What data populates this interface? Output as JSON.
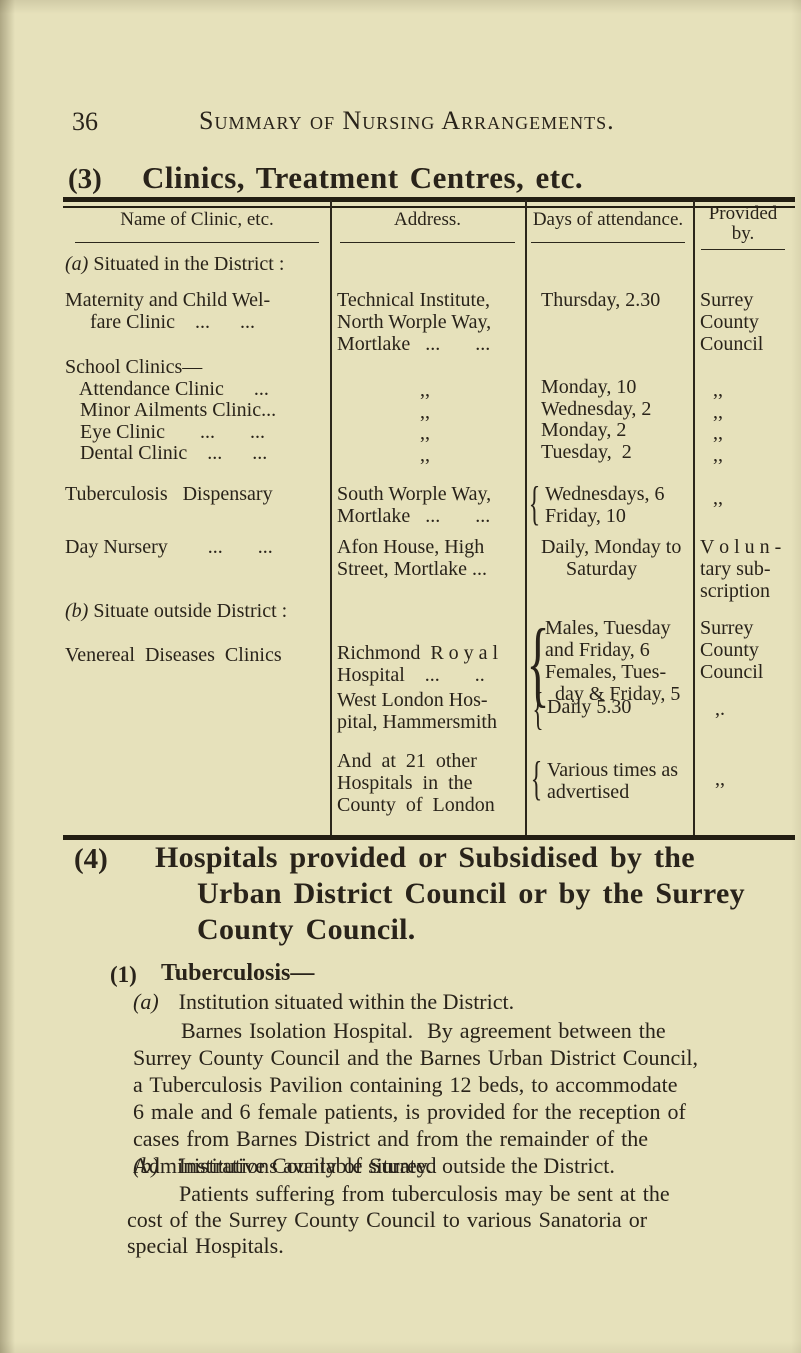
{
  "page": {
    "number": "36",
    "running_title": "Summary of Nursing Arrangements."
  },
  "section3": {
    "num": "(3)",
    "title": "Clinics, Treatment Centres, etc."
  },
  "table": {
    "brace_glyph": "{",
    "headers": {
      "name": "Name of Clinic, etc.",
      "address": "Address.",
      "days": "Days of attendance.",
      "provided": "Provided\nby."
    },
    "group_a": {
      "num": "(a)",
      "label": "Situated in the District :"
    },
    "maternity": {
      "name": "Maternity and Child Wel-\n     fare Clinic    ...      ...",
      "address": "Technical Institute,\nNorth Worple Way,\nMortlake   ...       ...",
      "days": "Thursday, 2.30",
      "provided": "Surrey\nCounty\nCouncil"
    },
    "school": {
      "name": "School Clinics—\n   Attendance Clinic      ...\n   Minor Ailments Clinic...\n   Eye Clinic       ...       ...\n   Dental Clinic    ...      ...",
      "address_ditto": ",,\n,,\n,,\n,,",
      "days": "Monday, 10\nWednesday, 2\nMonday, 2\nTuesday,  2",
      "provided_ditto": ",,\n,,\n,,\n,,"
    },
    "tuberculosis": {
      "name": "Tuberculosis   Dispensary",
      "address": "South Worple Way,\nMortlake   ...       ...",
      "days": "Wednesdays, 6\nFriday, 10",
      "provided": ",,"
    },
    "day_nursery": {
      "name": "Day Nursery        ...       ...",
      "address": "Afon House, High\nStreet, Mortlake ...",
      "days": "Daily, Monday to\n     Saturday",
      "provided": "V o l u n -\ntary sub-\nscription"
    },
    "group_b": {
      "num": "(b)",
      "label": "Situate outside District :"
    },
    "venereal": {
      "name": "Venereal  Diseases  Clinics",
      "address": "Richmond  R o y a l\nHospital    ...       ..",
      "days": "Males, Tuesday\nand Friday, 6\nFemales, Tues-\n  day & Friday, 5",
      "provided": "Surrey\nCounty\nCouncil"
    },
    "west_london": {
      "address": "West London Hos-\npital, Hammersmith",
      "days": "Daily 5.30",
      "provided": ",."
    },
    "other_hospitals": {
      "address": "And  at  21  other\nHospitals  in  the\nCounty  of  London",
      "days": "Various times as\nadvertised",
      "provided": ",,"
    }
  },
  "section4": {
    "num": "(4)",
    "lines": [
      "Hospitals provided or Subsidised by the",
      "Urban District Council or by the Surrey",
      "County Council."
    ]
  },
  "tuberculosis_section": {
    "num": "(1)",
    "title": "Tuberculosis—",
    "item_a": {
      "num": "(a)",
      "text": "Institution situated within the District."
    },
    "para_a": "Barnes Isolation Hospital.  By agreement between the\nSurrey County Council and the Barnes Urban District Council,\na Tuberculosis Pavilion containing 12 beds, to accommodate\n6 male and 6 female patients, is provided for the reception of\ncases from Barnes District and from the remainder of the\nAdministrative County of Surrey.",
    "item_b": {
      "num": "(b)",
      "text": "Institutions available situated outside the District."
    },
    "para_b": "Patients suffering from tuberculosis may be sent at the\ncost of the Surrey County Council to various Sanatoria or\nspecial Hospitals."
  }
}
